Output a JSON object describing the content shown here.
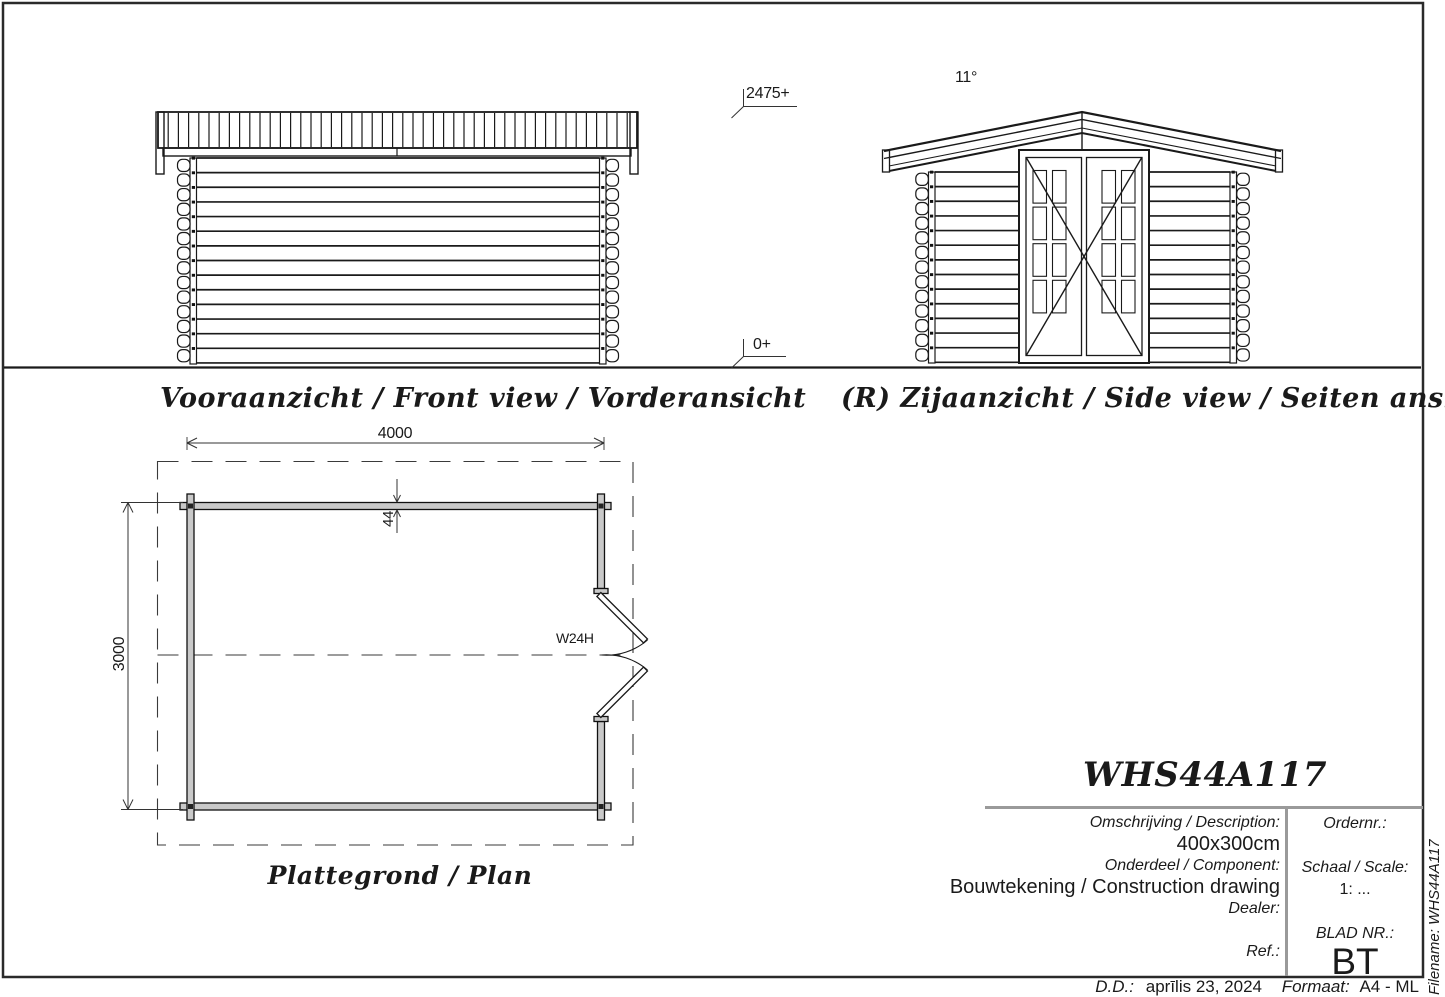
{
  "views": {
    "front_label": "Vooraanzicht / Front view / Vorderansicht",
    "side_label": "(R) Zijaanzicht / Side view / Seiten ansicht",
    "plan_label": "Plattegrond / Plan"
  },
  "annotations": {
    "ridge_height": "2475+",
    "ground_level": "0+",
    "roof_angle": "11°",
    "plan_width": "4000",
    "plan_depth": "3000",
    "wall_thickness": "44",
    "door_code": "W24H"
  },
  "title_block": {
    "model": "WHS44A117",
    "description_label": "Omschrijving / Description:",
    "description_value": "400x300cm",
    "component_label": "Onderdeel / Component:",
    "component_value": "Bouwtekening / Construction drawing",
    "dealer_label": "Dealer:",
    "ref_label": "Ref.:",
    "order_label": "Ordernr.:",
    "scale_label": "Schaal / Scale:",
    "scale_value": "1: ...",
    "sheet_label": "BLAD NR.:",
    "sheet_value": "BT"
  },
  "margins": {
    "filename": "Filename: WHS44A117",
    "date_label": "D.D.:",
    "date_value": "aprīlis 23, 2024",
    "format_label": "Formaat:",
    "format_value": "A4 - ML"
  },
  "colors": {
    "line": "#1a1a1a",
    "dim": "#333333",
    "rule_gray": "#9a9a9a",
    "wall_fill": "#c9c9c9"
  }
}
